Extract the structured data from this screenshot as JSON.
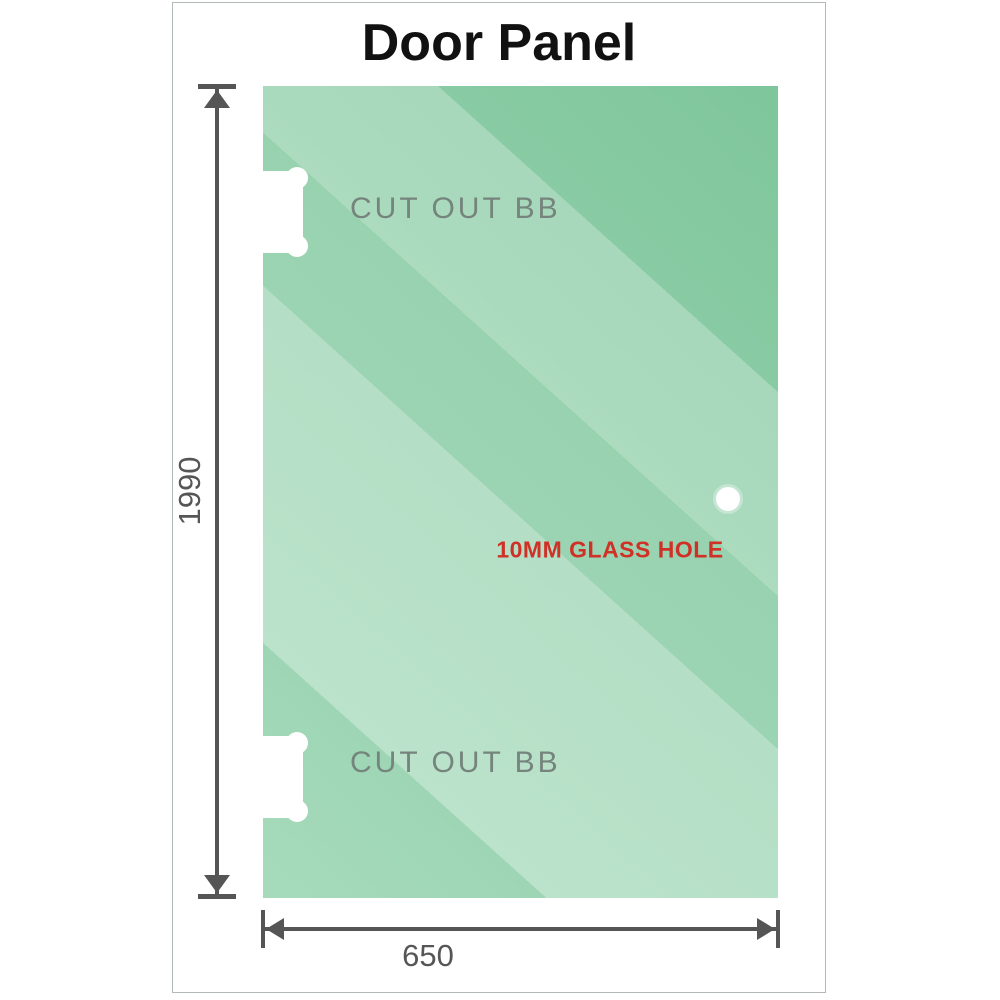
{
  "title": "Door Panel",
  "panel": {
    "cutout_top_label": "CUT OUT BB",
    "cutout_bottom_label": "CUT OUT BB",
    "hole_label": "10MM GLASS HOLE"
  },
  "dimensions": {
    "height_label": "1990",
    "width_label": "650"
  },
  "colors": {
    "glass_dark": "#7fc69c",
    "glass_light": "#b9e3c9",
    "dimension_line": "#555555",
    "cutout_text": "#75847c",
    "hole_text": "#cf3126",
    "frame_border": "#b3b8ba"
  }
}
